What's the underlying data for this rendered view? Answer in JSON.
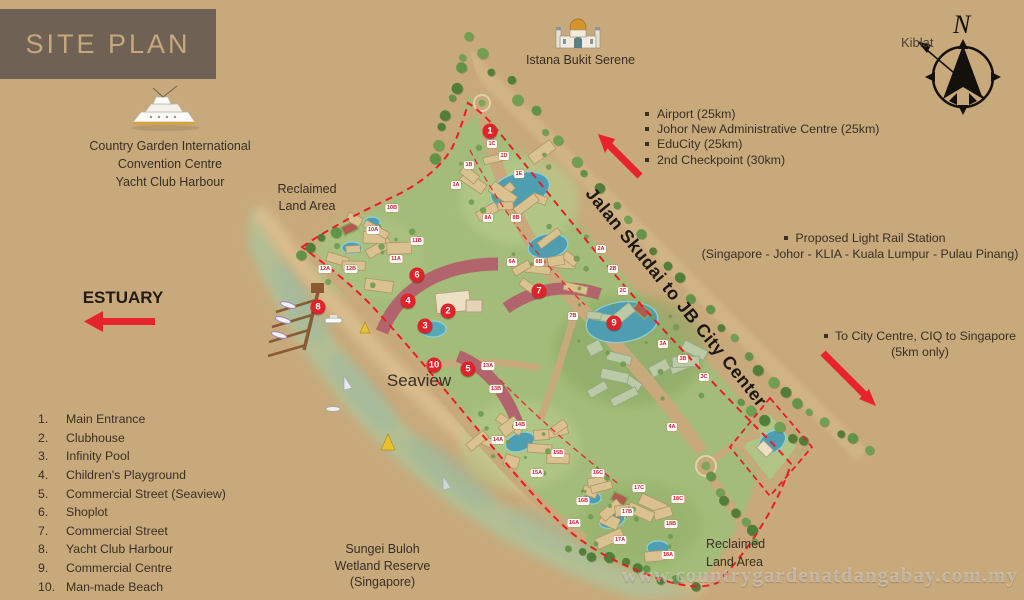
{
  "colors": {
    "background": "#c8a97b",
    "header_box": "#6f6254",
    "header_text": "#c6a87a",
    "text_dark": "#382f24",
    "accent_red": "#e0222b",
    "site_green": "#a3bc79",
    "water": "#b2c095",
    "pool_blue": "#4f9db0",
    "building_maroon": "#b2646c"
  },
  "header": {
    "title": "SITE PLAN",
    "convention_lines": [
      "Country Garden International",
      "Convention Centre",
      "Yacht Club Harbour"
    ]
  },
  "estuary_label": "ESTUARY",
  "legend": {
    "items": [
      {
        "num": "1.",
        "label": "Main Entrance"
      },
      {
        "num": "2.",
        "label": "Clubhouse"
      },
      {
        "num": "3.",
        "label": "Infinity Pool"
      },
      {
        "num": "4.",
        "label": "Children's Playground"
      },
      {
        "num": "5.",
        "label": "Commercial Street (Seaview)"
      },
      {
        "num": "6.",
        "label": "Shoplot"
      },
      {
        "num": "7.",
        "label": "Commercial Street"
      },
      {
        "num": "8.",
        "label": "Yacht Club Harbour"
      },
      {
        "num": "9.",
        "label": "Commercial Centre"
      },
      {
        "num": "10.",
        "label": "Man-made Beach"
      }
    ]
  },
  "nearby": {
    "items": [
      "Airport (25km)",
      "Johor New Administrative Centre (25km)",
      "EduCity (25km)",
      "2nd Checkpoint (30km)"
    ]
  },
  "light_rail": {
    "line1": "Proposed Light Rail Station",
    "line2": "(Singapore - Johor - KLIA - Kuala Lumpur - Pulau Pinang)"
  },
  "city_centre": {
    "line1": "To City Centre, CIQ to Singapore",
    "line2": "(5km only)"
  },
  "road_label": "Jalan Skudai to JB City Center",
  "compass": {
    "north_label": "N",
    "kiblat_label": "Kiblat"
  },
  "map_labels": {
    "istana": "Istana Bukit Serene",
    "reclaimed_top": [
      "Reclaimed",
      "Land Area"
    ],
    "seaview": "Seaview",
    "sungei": [
      "Sungei Buloh",
      "Wetland Reserve",
      "(Singapore)"
    ],
    "reclaimed_bottom": [
      "Reclaimed",
      "Land Area"
    ]
  },
  "watermark": "www.countrygardenatdangabay.com.my",
  "markers": [
    {
      "n": "1",
      "x": 490,
      "y": 131
    },
    {
      "n": "2",
      "x": 448,
      "y": 311
    },
    {
      "n": "3",
      "x": 425,
      "y": 326
    },
    {
      "n": "4",
      "x": 408,
      "y": 301
    },
    {
      "n": "5",
      "x": 468,
      "y": 369
    },
    {
      "n": "6",
      "x": 417,
      "y": 275
    },
    {
      "n": "7",
      "x": 539,
      "y": 291
    },
    {
      "n": "8",
      "x": 318,
      "y": 307
    },
    {
      "n": "9",
      "x": 614,
      "y": 323
    },
    {
      "n": "10",
      "x": 434,
      "y": 365
    }
  ],
  "plot_labels": [
    {
      "t": "1A",
      "x": 456,
      "y": 185
    },
    {
      "t": "1B",
      "x": 469,
      "y": 165
    },
    {
      "t": "1C",
      "x": 492,
      "y": 144
    },
    {
      "t": "1D",
      "x": 504,
      "y": 156
    },
    {
      "t": "1E",
      "x": 519,
      "y": 174
    },
    {
      "t": "8A",
      "x": 488,
      "y": 218
    },
    {
      "t": "8B",
      "x": 516,
      "y": 218
    },
    {
      "t": "6A",
      "x": 512,
      "y": 262
    },
    {
      "t": "6B",
      "x": 539,
      "y": 262
    },
    {
      "t": "2A",
      "x": 601,
      "y": 249
    },
    {
      "t": "2B",
      "x": 613,
      "y": 269
    },
    {
      "t": "2C",
      "x": 623,
      "y": 291
    },
    {
      "t": "3A",
      "x": 663,
      "y": 344
    },
    {
      "t": "3B",
      "x": 683,
      "y": 359
    },
    {
      "t": "3C",
      "x": 704,
      "y": 377
    },
    {
      "t": "4A",
      "x": 672,
      "y": 427
    },
    {
      "t": "7B",
      "x": 573,
      "y": 316
    },
    {
      "t": "10A",
      "x": 373,
      "y": 230
    },
    {
      "t": "10B",
      "x": 392,
      "y": 208
    },
    {
      "t": "11A",
      "x": 396,
      "y": 259
    },
    {
      "t": "11B",
      "x": 417,
      "y": 241
    },
    {
      "t": "12A",
      "x": 325,
      "y": 269
    },
    {
      "t": "12B",
      "x": 351,
      "y": 269
    },
    {
      "t": "13A",
      "x": 488,
      "y": 366
    },
    {
      "t": "13B",
      "x": 496,
      "y": 389
    },
    {
      "t": "14A",
      "x": 498,
      "y": 440
    },
    {
      "t": "14B",
      "x": 520,
      "y": 425
    },
    {
      "t": "15A",
      "x": 537,
      "y": 473
    },
    {
      "t": "15B",
      "x": 558,
      "y": 453
    },
    {
      "t": "16A",
      "x": 574,
      "y": 523
    },
    {
      "t": "16B",
      "x": 583,
      "y": 501
    },
    {
      "t": "16C",
      "x": 598,
      "y": 473
    },
    {
      "t": "17A",
      "x": 620,
      "y": 540
    },
    {
      "t": "17B",
      "x": 627,
      "y": 512
    },
    {
      "t": "17C",
      "x": 639,
      "y": 488
    },
    {
      "t": "18A",
      "x": 668,
      "y": 555
    },
    {
      "t": "18B",
      "x": 671,
      "y": 524
    },
    {
      "t": "18C",
      "x": 678,
      "y": 499
    }
  ]
}
